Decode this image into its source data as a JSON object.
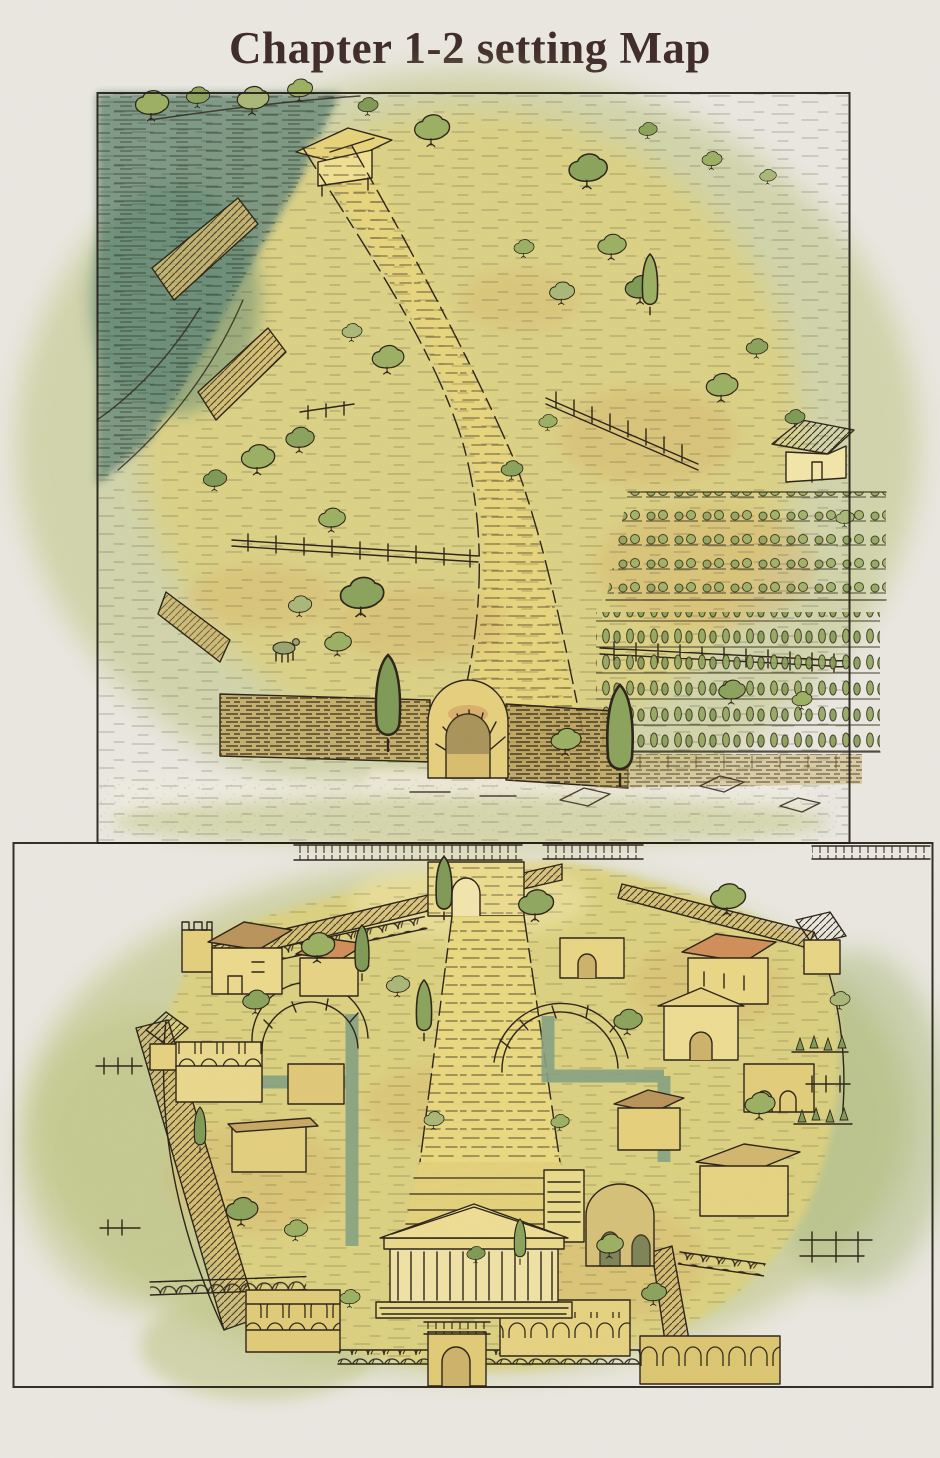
{
  "page": {
    "title": "Chapter 1-2 setting Map"
  },
  "palette": {
    "paper": "#eae8e1",
    "title_ink": "#3e2a27",
    "line_ink": "#2b2318",
    "road_yellow": "#e8d67d",
    "field_yellow": "#ddd17f",
    "meadow_green": "#c2c888",
    "wash_green": "#bdc47f",
    "tree_green": "#9cb063",
    "tree_dark": "#7f9a55",
    "sage": "#aab878",
    "water_teal": "#74937f",
    "water_deep": "#5d8772",
    "street_teal": "#85a182",
    "ochre": "#d8b56c",
    "stone_tan": "#d2b66f",
    "roof_orange": "#d08d58",
    "roof_brown": "#b9935a"
  }
}
